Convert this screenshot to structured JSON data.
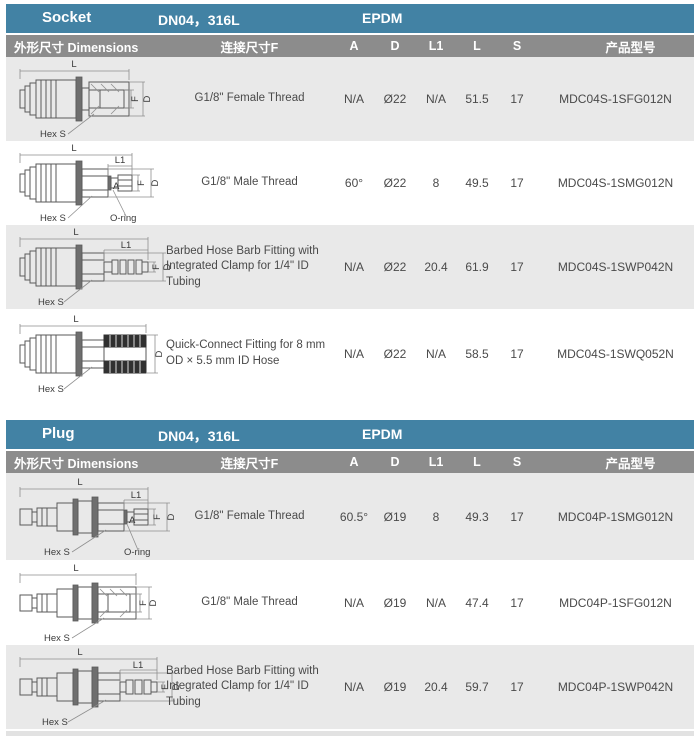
{
  "colors": {
    "section_bar": "#4282a4",
    "column_header": "#8c8c8c",
    "row_alt": "#e9e9e9",
    "text": "#4a4a4a"
  },
  "columns": {
    "dimensions": "外形尺寸 Dimensions",
    "thread": "连接尺寸F",
    "a": "A",
    "d": "D",
    "l1": "L1",
    "l": "L",
    "s": "S",
    "product": "产品型号"
  },
  "drawing_labels": {
    "l": "L",
    "l1": "L1",
    "a": "A",
    "f": "F",
    "d": "D",
    "hex": "Hex S",
    "oring": "O-ring"
  },
  "socket": {
    "title": "Socket",
    "spec": "DN04，316L",
    "seal": "EPDM",
    "rows": [
      {
        "desc": "G1/8\" Female Thread",
        "a": "N/A",
        "d": "Ø22",
        "l1": "N/A",
        "l": "51.5",
        "s": "17",
        "product": "MDC04S-1SFG012N"
      },
      {
        "desc": "G1/8\" Male Thread",
        "a": "60°",
        "d": "Ø22",
        "l1": "8",
        "l": "49.5",
        "s": "17",
        "product": "MDC04S-1SMG012N"
      },
      {
        "desc": "Barbed Hose Barb Fitting with Integrated Clamp for 1/4\" ID Tubing",
        "a": "N/A",
        "d": "Ø22",
        "l1": "20.4",
        "l": "61.9",
        "s": "17",
        "product": "MDC04S-1SWP042N"
      },
      {
        "desc": "Quick-Connect Fitting for 8 mm OD × 5.5 mm ID Hose",
        "a": "N/A",
        "d": "Ø22",
        "l1": "N/A",
        "l": "58.5",
        "s": "17",
        "product": "MDC04S-1SWQ052N"
      }
    ]
  },
  "plug": {
    "title": "Plug",
    "spec": "DN04，316L",
    "seal": "EPDM",
    "rows": [
      {
        "desc": "G1/8\" Female Thread",
        "a": "60.5°",
        "d": "Ø19",
        "l1": "8",
        "l": "49.3",
        "s": "17",
        "product": "MDC04P-1SMG012N"
      },
      {
        "desc": "G1/8\" Male Thread",
        "a": "N/A",
        "d": "Ø19",
        "l1": "N/A",
        "l": "47.4",
        "s": "17",
        "product": "MDC04P-1SFG012N"
      },
      {
        "desc": "Barbed Hose Barb Fitting with Integrated Clamp for 1/4\" ID Tubing",
        "a": "N/A",
        "d": "Ø19",
        "l1": "20.4",
        "l": "59.7",
        "s": "17",
        "product": "MDC04P-1SWP042N"
      }
    ]
  }
}
